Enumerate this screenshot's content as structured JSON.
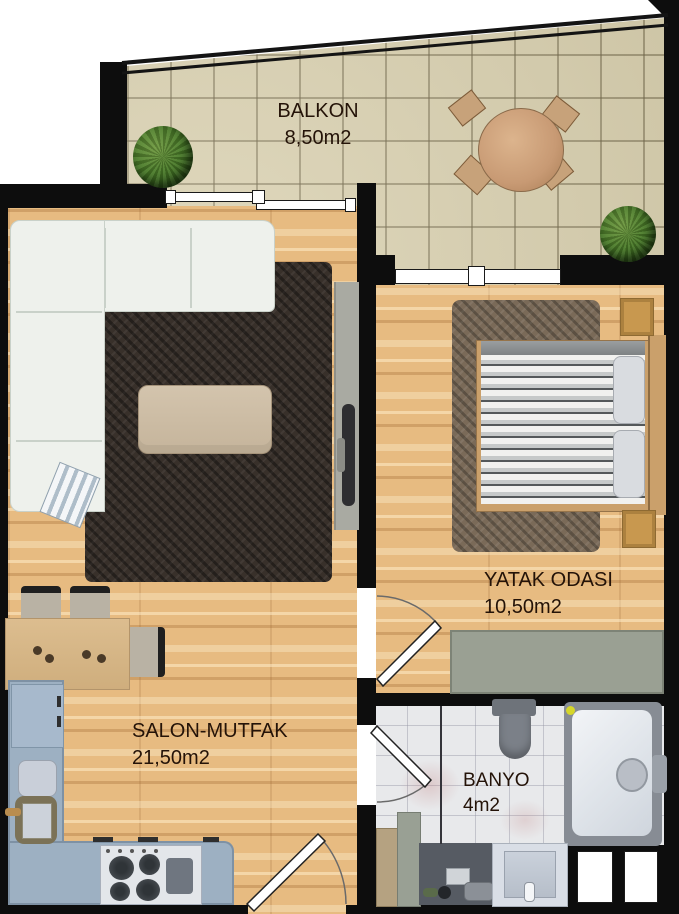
{
  "rooms": [
    {
      "id": "balkon",
      "name": "BALKON",
      "area": "8,50m2"
    },
    {
      "id": "yatak-odasi",
      "name": "YATAK ODASI",
      "area": "10,50m2"
    },
    {
      "id": "salon-mutfak",
      "name": "SALON-MUTFAK",
      "area": "21,50m2"
    },
    {
      "id": "banyo",
      "name": "BANYO",
      "area": "4m2"
    }
  ],
  "colors": {
    "wall": "#0d0d0d",
    "wood_floor": "#e7bb81",
    "balcony_tile": "#d8cfae",
    "bathroom_tile": "#e8e9eb",
    "label_text": "#241308",
    "kitchen_counter": "#9db0c2",
    "salon_rug": "#38302a",
    "bedroom_rug": "#7a6a58",
    "sofa": "#eef1ec",
    "wardrobe": "#9aa093",
    "plant": "#497a28",
    "door_leaf": "#ffffff"
  }
}
